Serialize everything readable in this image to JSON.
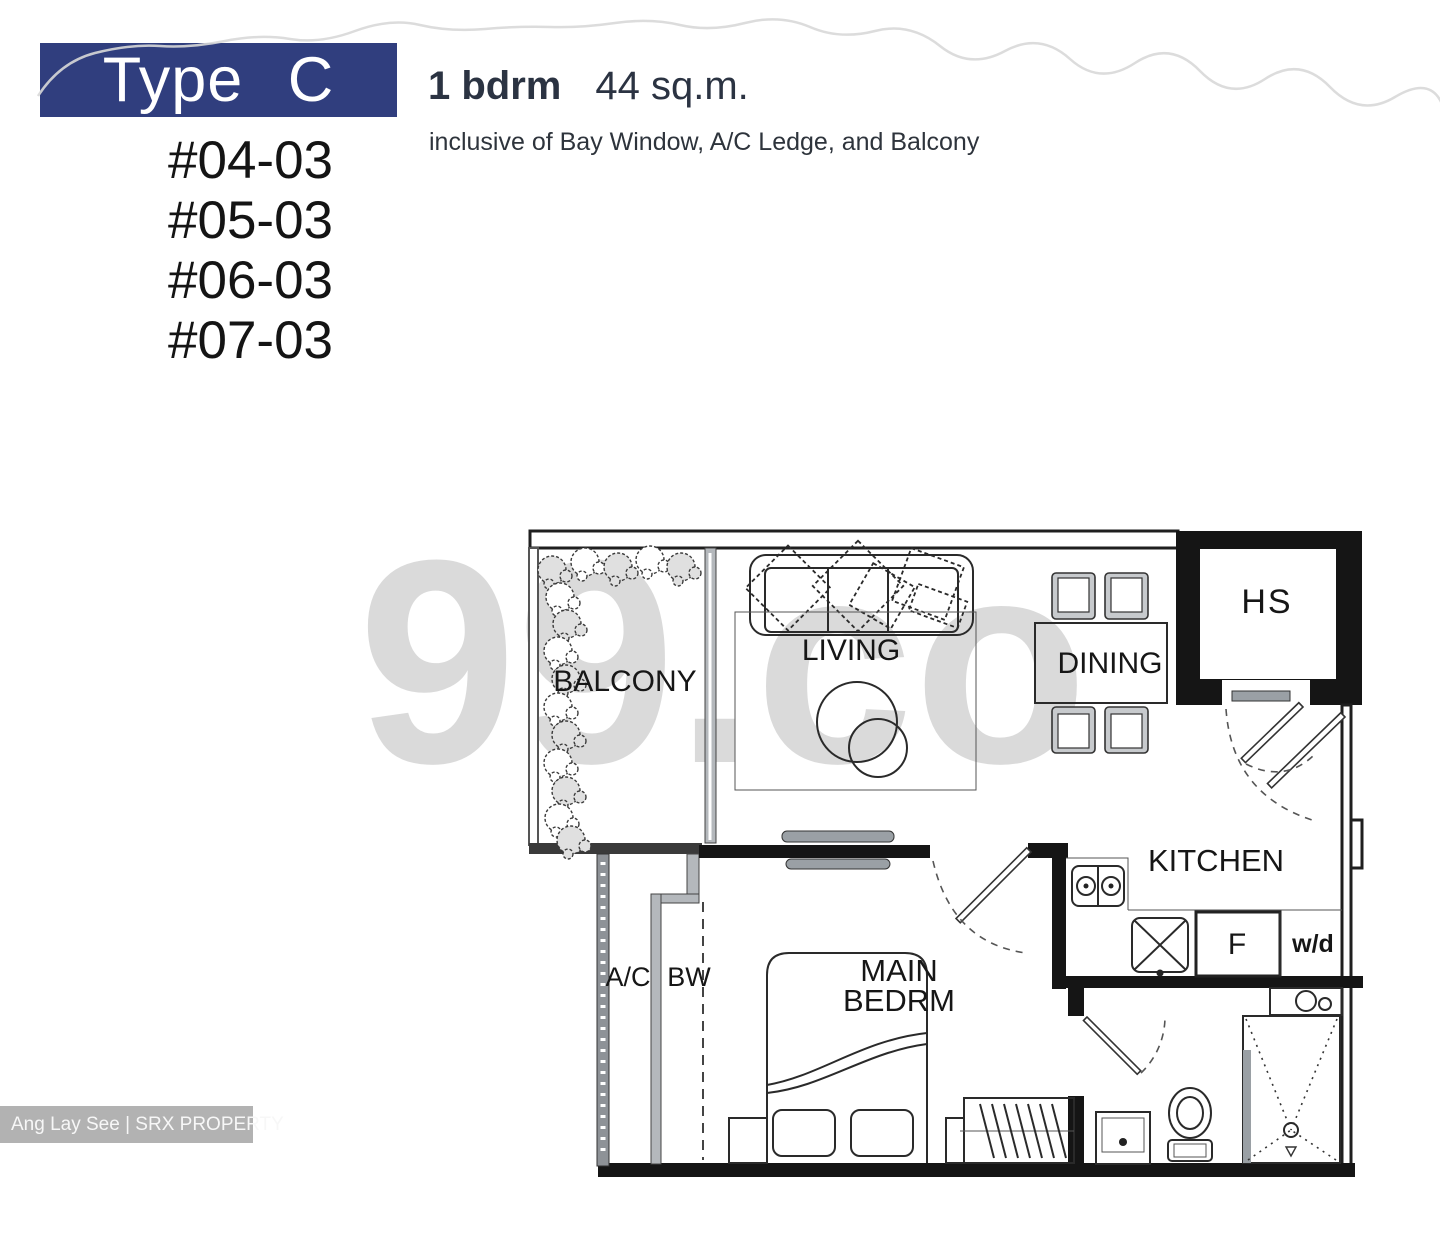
{
  "header": {
    "type_label": "Type C",
    "bedroom_info": "1 bdrm",
    "area_info": "44 sq.m.",
    "inclusive_note": "inclusive of Bay Window, A/C Ledge, and Balcony",
    "units": [
      "#04-03",
      "#05-03",
      "#06-03",
      "#07-03"
    ]
  },
  "watermark": "99.co",
  "credit": "Ang Lay See | SRX PROPERTY",
  "floorplan": {
    "rooms": {
      "balcony": "BALCONY",
      "living": "LIVING",
      "dining": "DINING",
      "hs": "HS",
      "kitchen": "KITCHEN",
      "main_bedroom_line1": "MAIN",
      "main_bedroom_line2": "BEDRM",
      "ac_ledge": "A/C",
      "bay_window": "BW",
      "fridge": "F",
      "washer_dryer": "w/d"
    }
  },
  "colors": {
    "banner": "#303e7e",
    "line": "#1f1f1f",
    "watermark": "#d2d2d2",
    "creditbar": "#b2b2b2"
  }
}
